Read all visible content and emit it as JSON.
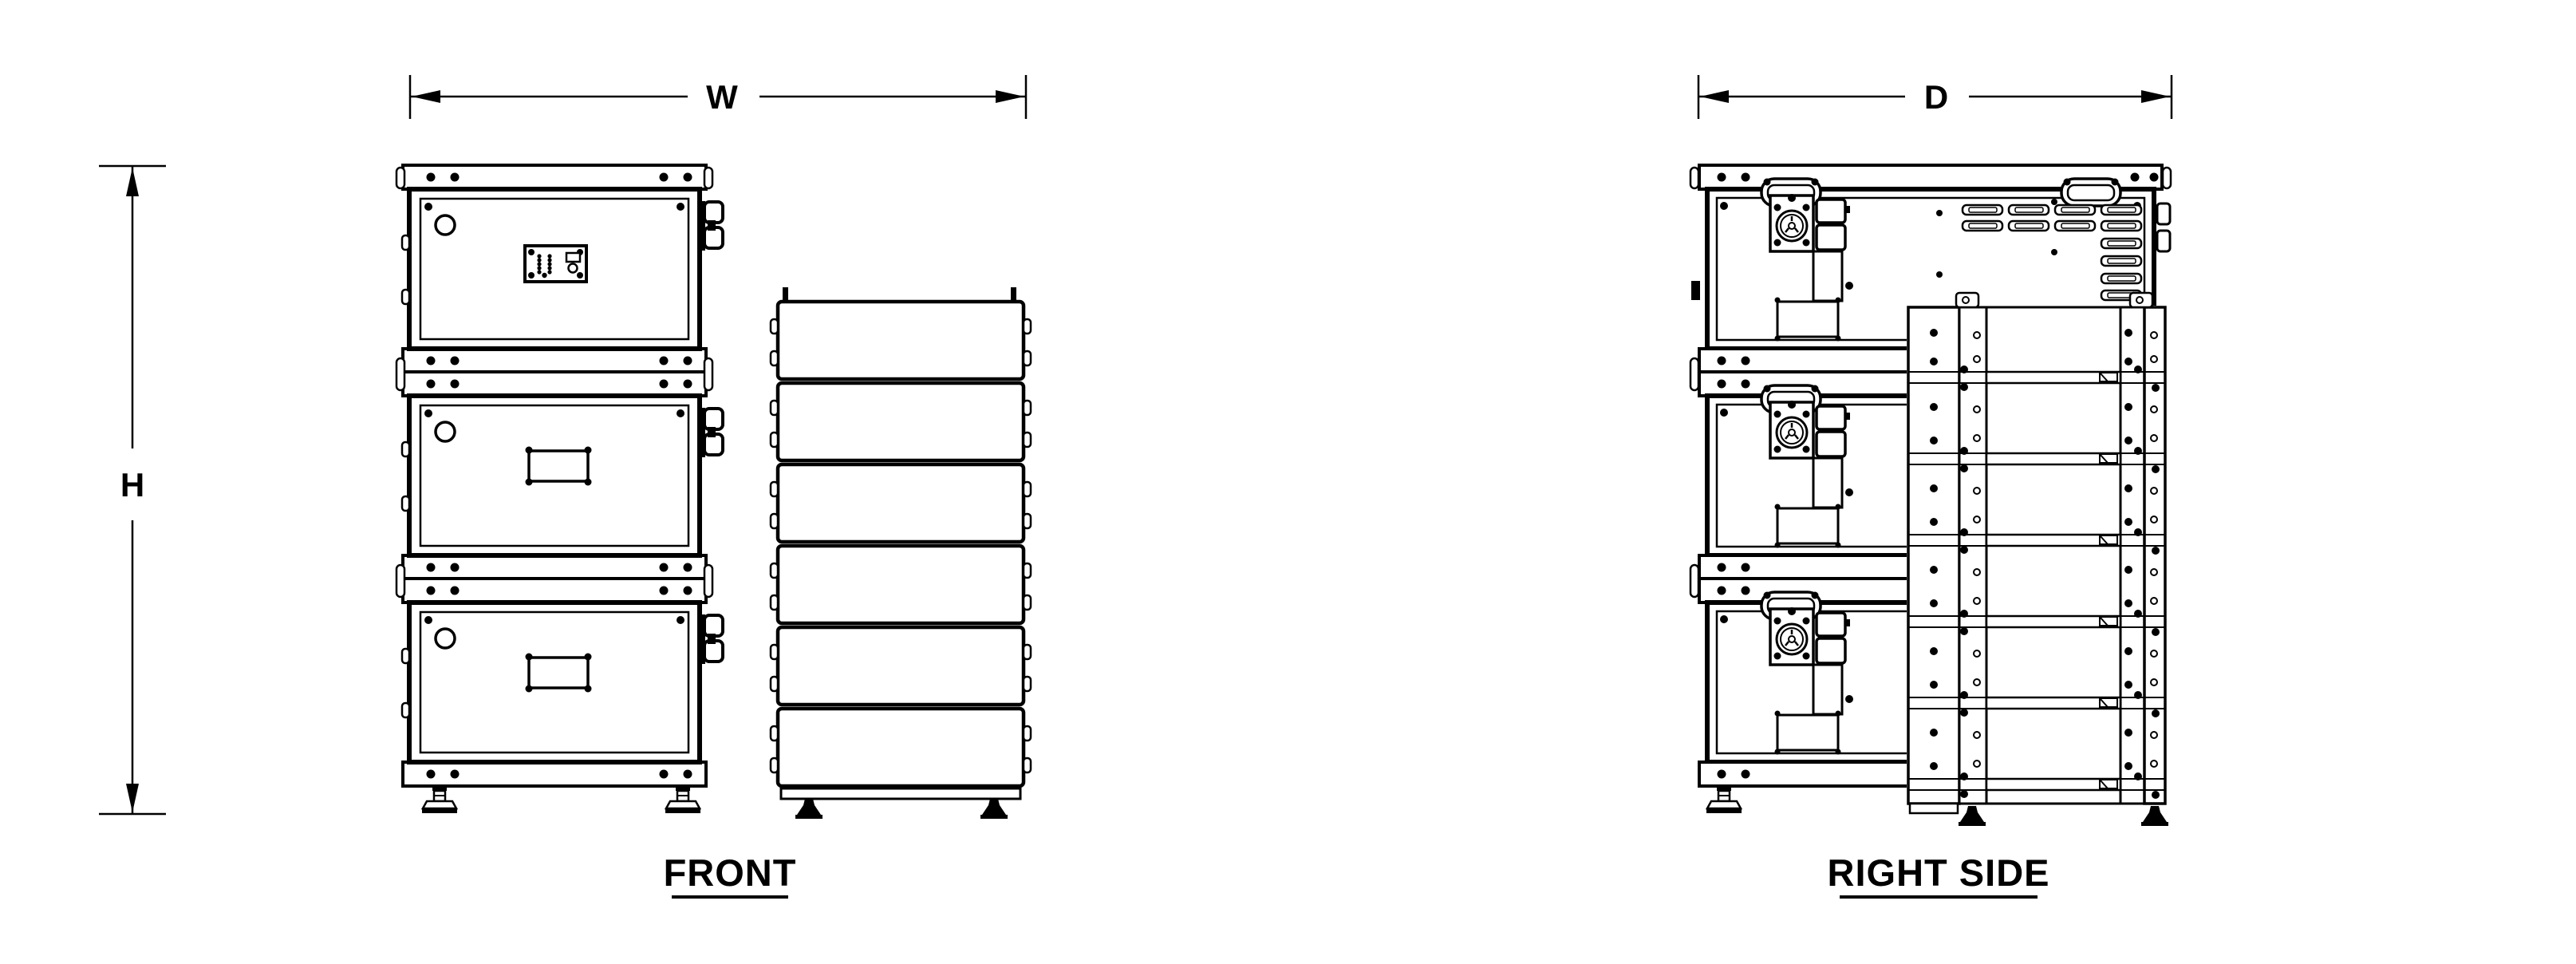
{
  "drawing": {
    "background_color": "#ffffff",
    "stroke_color": "#000000",
    "type": "orthographic-dimension-drawing",
    "dimensions": {
      "width_label": "W",
      "height_label": "H",
      "depth_label": "D"
    },
    "views": {
      "front": {
        "label": "FRONT"
      },
      "right_side": {
        "label": "RIGHT SIDE"
      }
    }
  }
}
